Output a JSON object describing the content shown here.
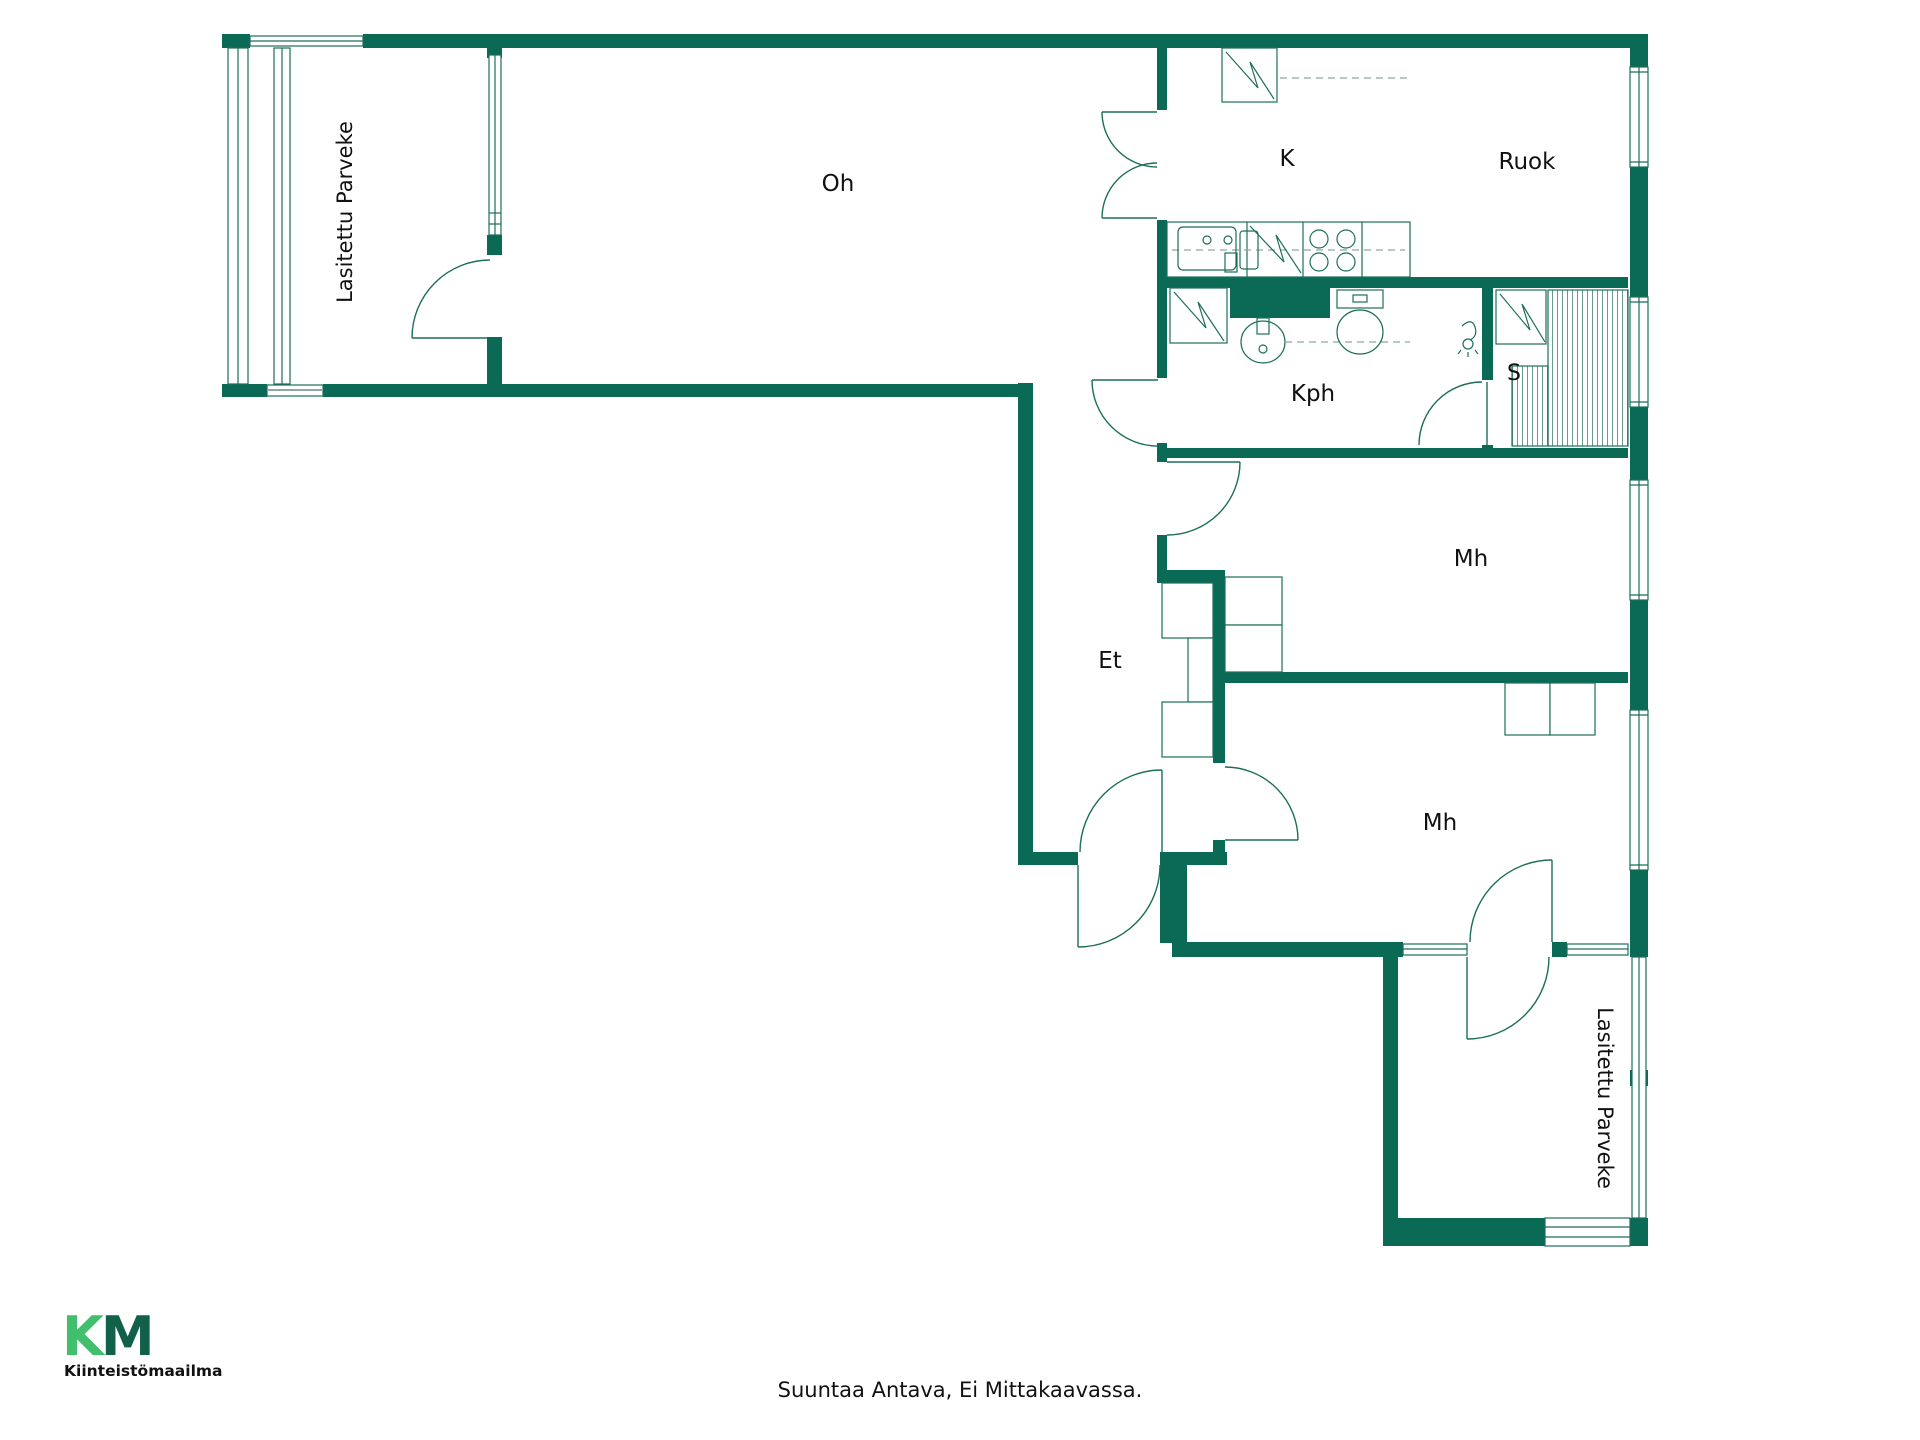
{
  "floorplan": {
    "rooms": {
      "balcony_top": {
        "label": "Lasitettu Parveke"
      },
      "living": {
        "label": "Oh"
      },
      "kitchen": {
        "label": "K"
      },
      "dining": {
        "label": "Ruok"
      },
      "bathroom": {
        "label": "Kph"
      },
      "sauna": {
        "label": "S"
      },
      "bedroom_top": {
        "label": "Mh"
      },
      "hall": {
        "label": "Et"
      },
      "bedroom_bottom": {
        "label": "Mh"
      },
      "balcony_bottom": {
        "label": "Lasitettu Parveke"
      }
    },
    "colors": {
      "wall": "#0b6a55",
      "line": "#1d6e5a",
      "dash": "#8fa8a2",
      "label_text": "#111111"
    }
  },
  "footer": {
    "disclaimer": "Suuntaa Antava, Ei Mittakaavassa."
  },
  "logo": {
    "monogram_k": "K",
    "monogram_m": "M",
    "company": "Kiinteistömaailma",
    "light_green": "#41bf6e",
    "dark_green": "#11604a"
  }
}
